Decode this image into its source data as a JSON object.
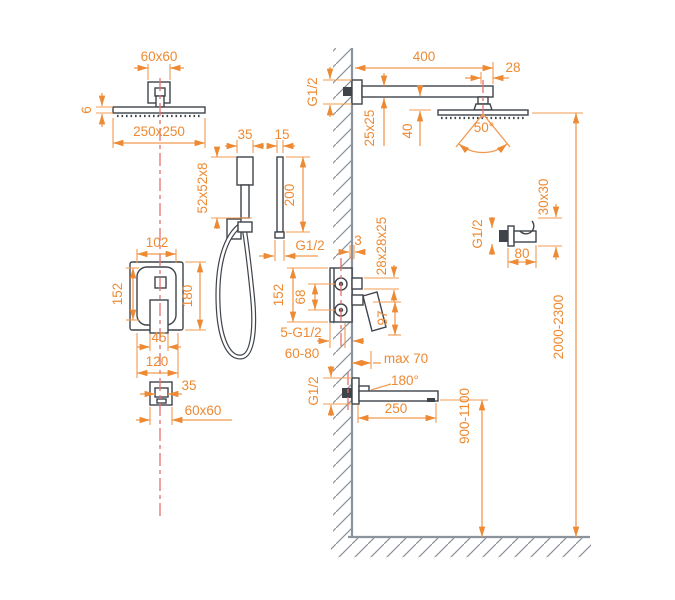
{
  "colors": {
    "dim": "#ED8A33",
    "dimline": "#F09B50",
    "line": "#3F444A",
    "wall": "#8C939C",
    "center": "#E57070",
    "hatch": "#8B9199",
    "bg": "#FFFFFF"
  },
  "labels": {
    "ceiling_arm_size": "60x60",
    "head_thickness": "6",
    "head_size": "250x250",
    "handshower_width": "35",
    "handshower_depth": "15",
    "handshower_head": "52x52x8",
    "handshower_length": "200",
    "hose_thread": "G1/2",
    "trim_inner_width": "102",
    "trim_inner_height": "152",
    "trim_height": "180",
    "handle_width": "45",
    "trim_width": "120",
    "spout_front_width": "35",
    "spout_escutcheon": "60x60",
    "arm_thread": "G1/2",
    "arm_length": "400",
    "head_offset": "28",
    "arm_section": "25x25",
    "head_drop": "40",
    "spray_angle": "50°",
    "holder_thread": "G1/2",
    "holder_section": "30x30",
    "holder_length": "80",
    "wall_offset": "3",
    "valve_section": "28x28x25",
    "valve_height": "152",
    "port_spacing": "68",
    "lever_drop": "97",
    "connections_note": "5-G1/2",
    "embed_depth": "60-80",
    "max_depth": "max 70",
    "spout_swivel": "180°",
    "spout_thread": "G1/2",
    "spout_length": "250",
    "spout_height_range": "900-1100",
    "head_height_range": "2000-2300"
  }
}
